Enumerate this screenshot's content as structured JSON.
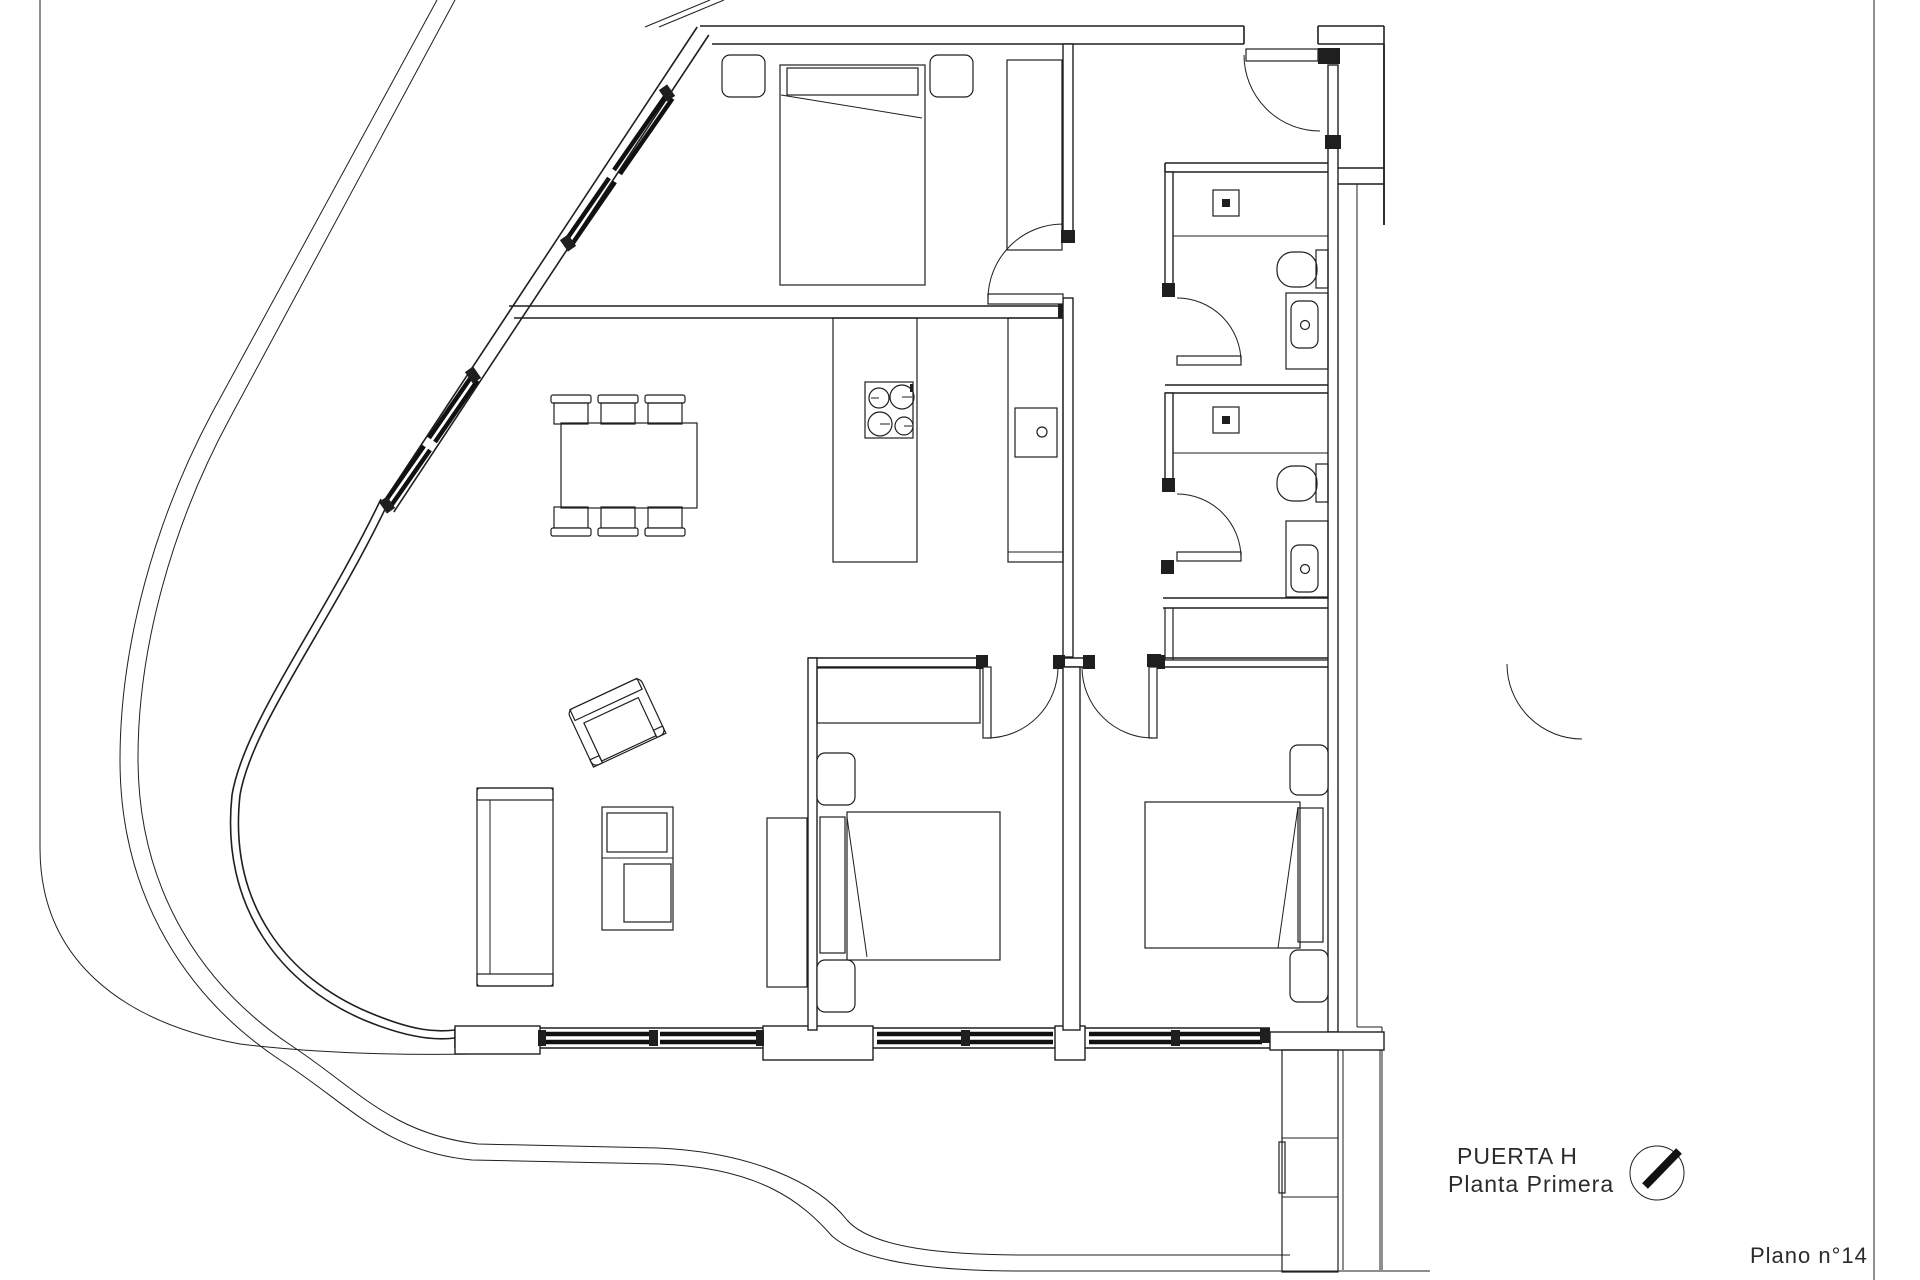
{
  "sheet": {
    "door_label": "PUERTA H",
    "floor_label": "Planta Primera",
    "sheet_number": "Plano n°14"
  },
  "icons": {
    "north_arrow": "north-arrow"
  },
  "colors": {
    "line": "#1f1f1f",
    "background": "#ffffff",
    "window_fill": "#111111"
  }
}
